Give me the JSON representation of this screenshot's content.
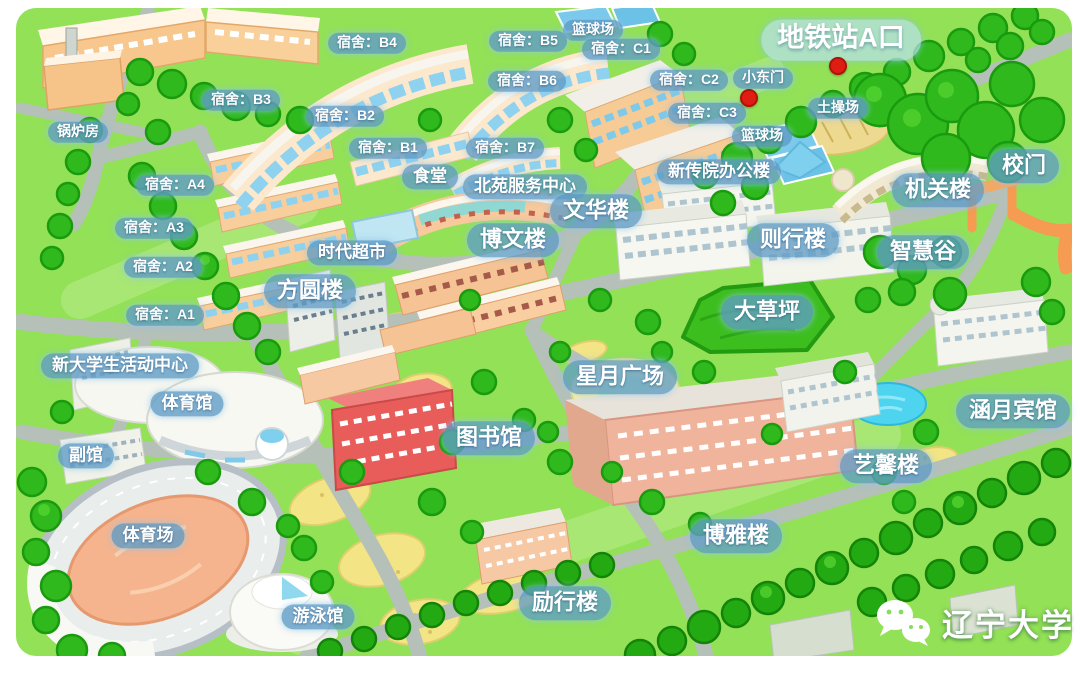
{
  "map": {
    "watermark": {
      "text": "辽宁大学",
      "icon": "wechat-icon"
    },
    "markers": [
      {
        "name": "metro-exit-marker",
        "x": 838,
        "y": 66
      },
      {
        "name": "small-east-gate-marker",
        "x": 749,
        "y": 98
      }
    ],
    "colors": {
      "grass": "#93e156",
      "road": "#b5c0b9",
      "tree": "#2fb91c",
      "lawn": "#3dbe1f",
      "path_sand": "#f3e486",
      "building_wall": "#f8cd9e",
      "glass": "#8fd2ef",
      "library_red": "#e85c5a",
      "gate_orange": "#f59b52",
      "marker_red": "#e01d12",
      "label_bg": "rgba(96,156,199,0.8)",
      "water": "#4fd4f0"
    },
    "labels": [
      {
        "id": "metro-exit-a",
        "text": "地铁站A口",
        "x": 841,
        "y": 40,
        "size": "xl"
      },
      {
        "id": "small-east-gate",
        "text": "小东门",
        "x": 763,
        "y": 78,
        "size": "sm"
      },
      {
        "id": "dirt-field",
        "text": "土操场",
        "x": 838,
        "y": 108,
        "size": "sm"
      },
      {
        "id": "basketball-court-top",
        "text": "篮球场",
        "x": 593,
        "y": 30,
        "size": "sm"
      },
      {
        "id": "basketball-court-east",
        "text": "篮球场",
        "x": 762,
        "y": 136,
        "size": "sm"
      },
      {
        "id": "dorm-b4",
        "text": "宿舍：B4",
        "x": 367,
        "y": 43,
        "size": "sm"
      },
      {
        "id": "dorm-b5",
        "text": "宿舍：B5",
        "x": 528,
        "y": 41,
        "size": "sm"
      },
      {
        "id": "dorm-c1",
        "text": "宿舍：C1",
        "x": 621,
        "y": 49,
        "size": "sm"
      },
      {
        "id": "dorm-c2",
        "text": "宿舍：C2",
        "x": 689,
        "y": 80,
        "size": "sm"
      },
      {
        "id": "dorm-b3",
        "text": "宿舍：B3",
        "x": 241,
        "y": 100,
        "size": "sm"
      },
      {
        "id": "dorm-b6",
        "text": "宿舍：B6",
        "x": 527,
        "y": 81,
        "size": "sm"
      },
      {
        "id": "dorm-c3",
        "text": "宿舍：C3",
        "x": 707,
        "y": 113,
        "size": "sm"
      },
      {
        "id": "dorm-b2",
        "text": "宿舍：B2",
        "x": 345,
        "y": 116,
        "size": "sm"
      },
      {
        "id": "dorm-b1",
        "text": "宿舍：B1",
        "x": 388,
        "y": 148,
        "size": "sm"
      },
      {
        "id": "dorm-b7",
        "text": "宿舍：B7",
        "x": 505,
        "y": 148,
        "size": "sm"
      },
      {
        "id": "boiler-house",
        "text": "锅炉房",
        "x": 78,
        "y": 132,
        "size": "sm"
      },
      {
        "id": "dorm-a4",
        "text": "宿舍：A4",
        "x": 175,
        "y": 185,
        "size": "sm"
      },
      {
        "id": "canteen",
        "text": "食堂",
        "x": 430,
        "y": 177,
        "size": "md"
      },
      {
        "id": "beiyuan-service-center",
        "text": "北苑服务中心",
        "x": 525,
        "y": 187,
        "size": "md"
      },
      {
        "id": "media-school-office",
        "text": "新传院办公楼",
        "x": 719,
        "y": 172,
        "size": "md"
      },
      {
        "id": "wenhua-building",
        "text": "文华楼",
        "x": 596,
        "y": 211,
        "size": "lg"
      },
      {
        "id": "admin-building",
        "text": "机关楼",
        "x": 938,
        "y": 190,
        "size": "lg"
      },
      {
        "id": "school-gate",
        "text": "校门",
        "x": 1024,
        "y": 166,
        "size": "lg"
      },
      {
        "id": "dorm-a3",
        "text": "宿舍：A3",
        "x": 154,
        "y": 228,
        "size": "sm"
      },
      {
        "id": "zexing-building",
        "text": "则行楼",
        "x": 793,
        "y": 240,
        "size": "lg"
      },
      {
        "id": "wisdom-valley",
        "text": "智慧谷",
        "x": 923,
        "y": 252,
        "size": "lg"
      },
      {
        "id": "shidai-supermarket",
        "text": "时代超市",
        "x": 352,
        "y": 253,
        "size": "md"
      },
      {
        "id": "bowen-building",
        "text": "博文楼",
        "x": 513,
        "y": 240,
        "size": "lg"
      },
      {
        "id": "dorm-a2",
        "text": "宿舍：A2",
        "x": 163,
        "y": 267,
        "size": "sm"
      },
      {
        "id": "fangyuan-building",
        "text": "方圆楼",
        "x": 310,
        "y": 291,
        "size": "lg"
      },
      {
        "id": "great-lawn",
        "text": "大草坪",
        "x": 767,
        "y": 312,
        "size": "lg"
      },
      {
        "id": "dorm-a1",
        "text": "宿舍：A1",
        "x": 165,
        "y": 315,
        "size": "sm"
      },
      {
        "id": "new-student-activity-center",
        "text": "新大学生活动中心",
        "x": 120,
        "y": 366,
        "size": "md"
      },
      {
        "id": "xingyue-plaza",
        "text": "星月广场",
        "x": 620,
        "y": 377,
        "size": "lg"
      },
      {
        "id": "gymnasium",
        "text": "体育馆",
        "x": 187,
        "y": 404,
        "size": "md"
      },
      {
        "id": "hanyue-hotel",
        "text": "涵月宾馆",
        "x": 1013,
        "y": 411,
        "size": "lg"
      },
      {
        "id": "library",
        "text": "图书馆",
        "x": 489,
        "y": 438,
        "size": "lg"
      },
      {
        "id": "annex-hall",
        "text": "副馆",
        "x": 86,
        "y": 456,
        "size": "md"
      },
      {
        "id": "yixin-building",
        "text": "艺馨楼",
        "x": 886,
        "y": 466,
        "size": "lg"
      },
      {
        "id": "boya-building",
        "text": "博雅楼",
        "x": 736,
        "y": 536,
        "size": "lg"
      },
      {
        "id": "stadium",
        "text": "体育场",
        "x": 148,
        "y": 536,
        "size": "md"
      },
      {
        "id": "swimming-pool",
        "text": "游泳馆",
        "x": 318,
        "y": 617,
        "size": "md"
      },
      {
        "id": "lixing-building",
        "text": "励行楼",
        "x": 565,
        "y": 603,
        "size": "lg"
      }
    ]
  }
}
